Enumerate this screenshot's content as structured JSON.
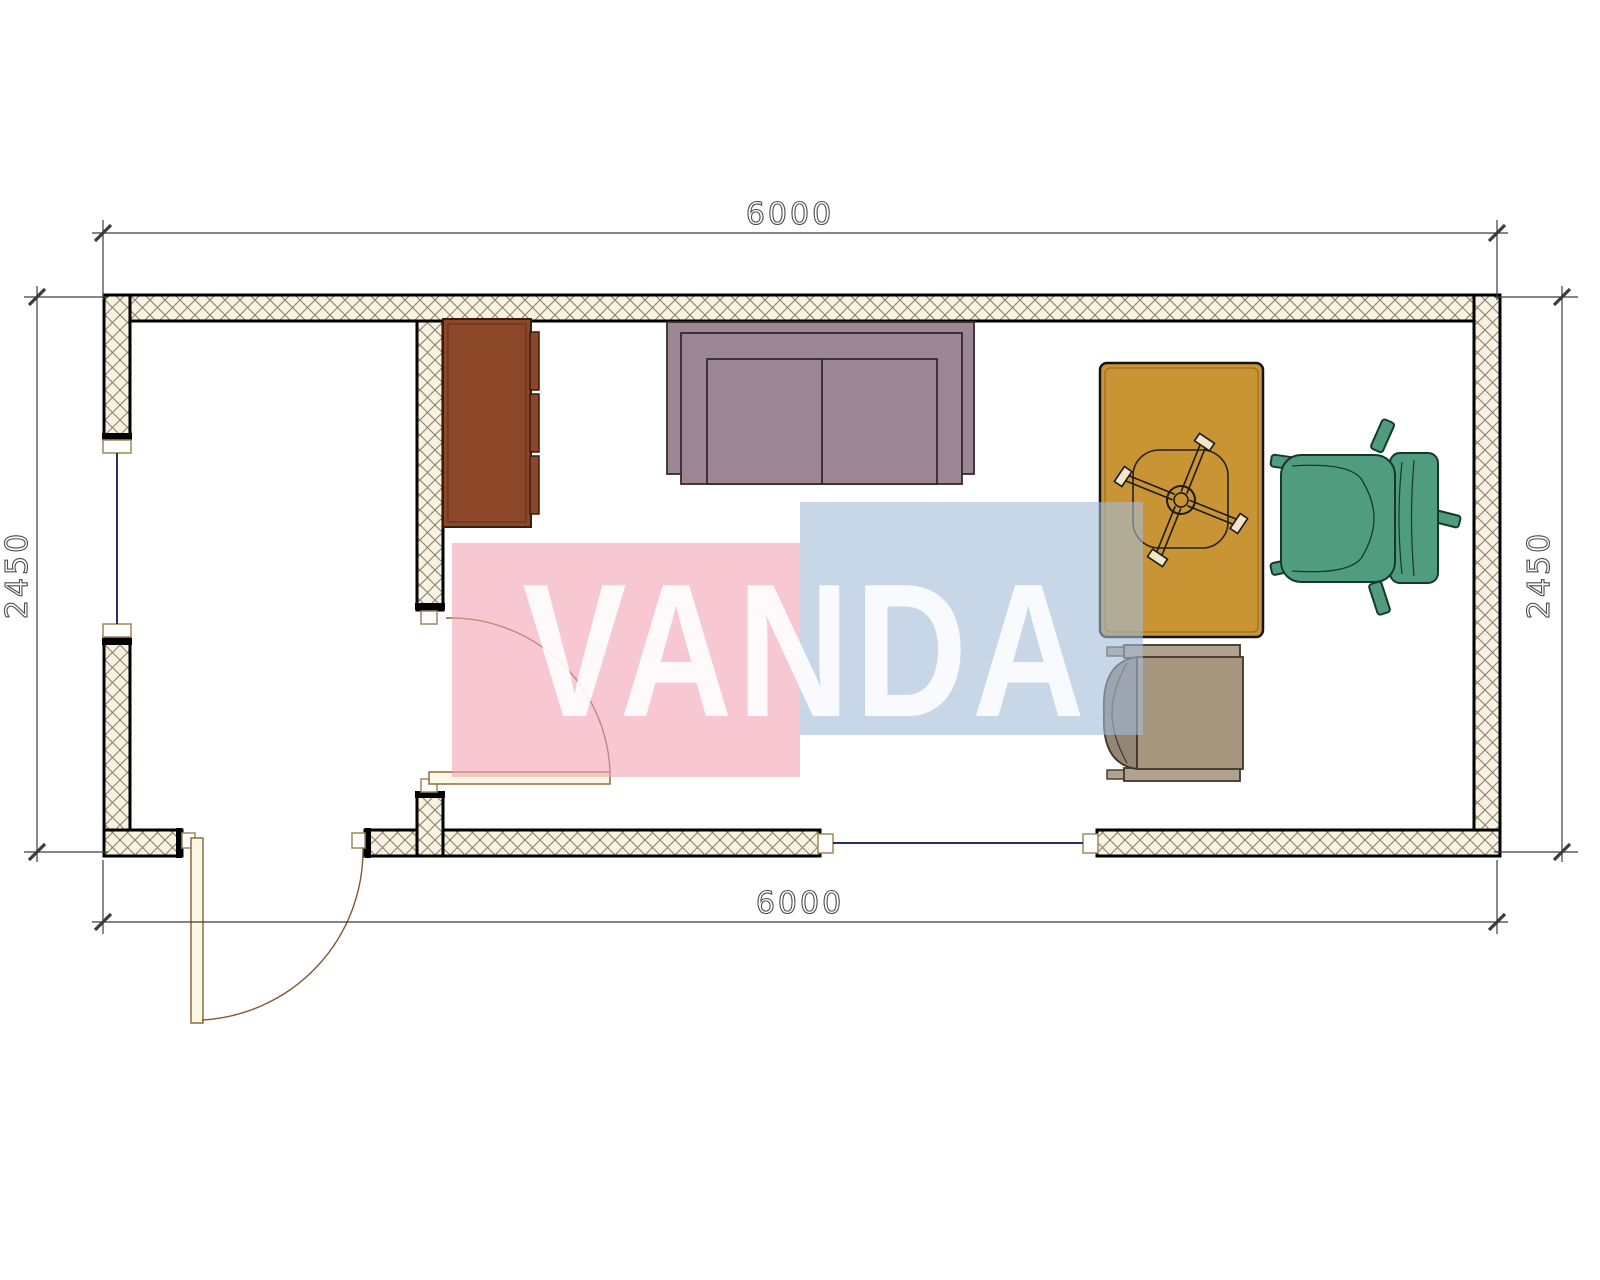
{
  "drawing": {
    "type": "floor-plan",
    "room_width_mm": "6000",
    "room_depth_mm": "2450"
  },
  "dimensions": {
    "top": "6000",
    "bottom": "6000",
    "left": "2450",
    "right": "2450"
  },
  "watermark": {
    "text": "VANDA",
    "pink": "#f2a3b4",
    "blue": "#a3bcd9",
    "text_color": "#ffffff"
  },
  "colors": {
    "wall_hatch_bg": "#f7f2e3",
    "wall_hatch_line": "#8d8066",
    "wall_outline": "#000000",
    "window_line": "#2e2e5e",
    "door_fill": "#fdf8e6",
    "door_stroke": "#8a6f3c",
    "dim_line": "#3c3c3c",
    "cabinet": "#8b4728",
    "sofa": "#9e8794",
    "desk": "#c99433",
    "desk_chair_seat": "#a8977f",
    "desk_chair_arm": "#b1a28d",
    "desk_chair_back": "#958574",
    "office_chair": "#4f9d7e"
  }
}
